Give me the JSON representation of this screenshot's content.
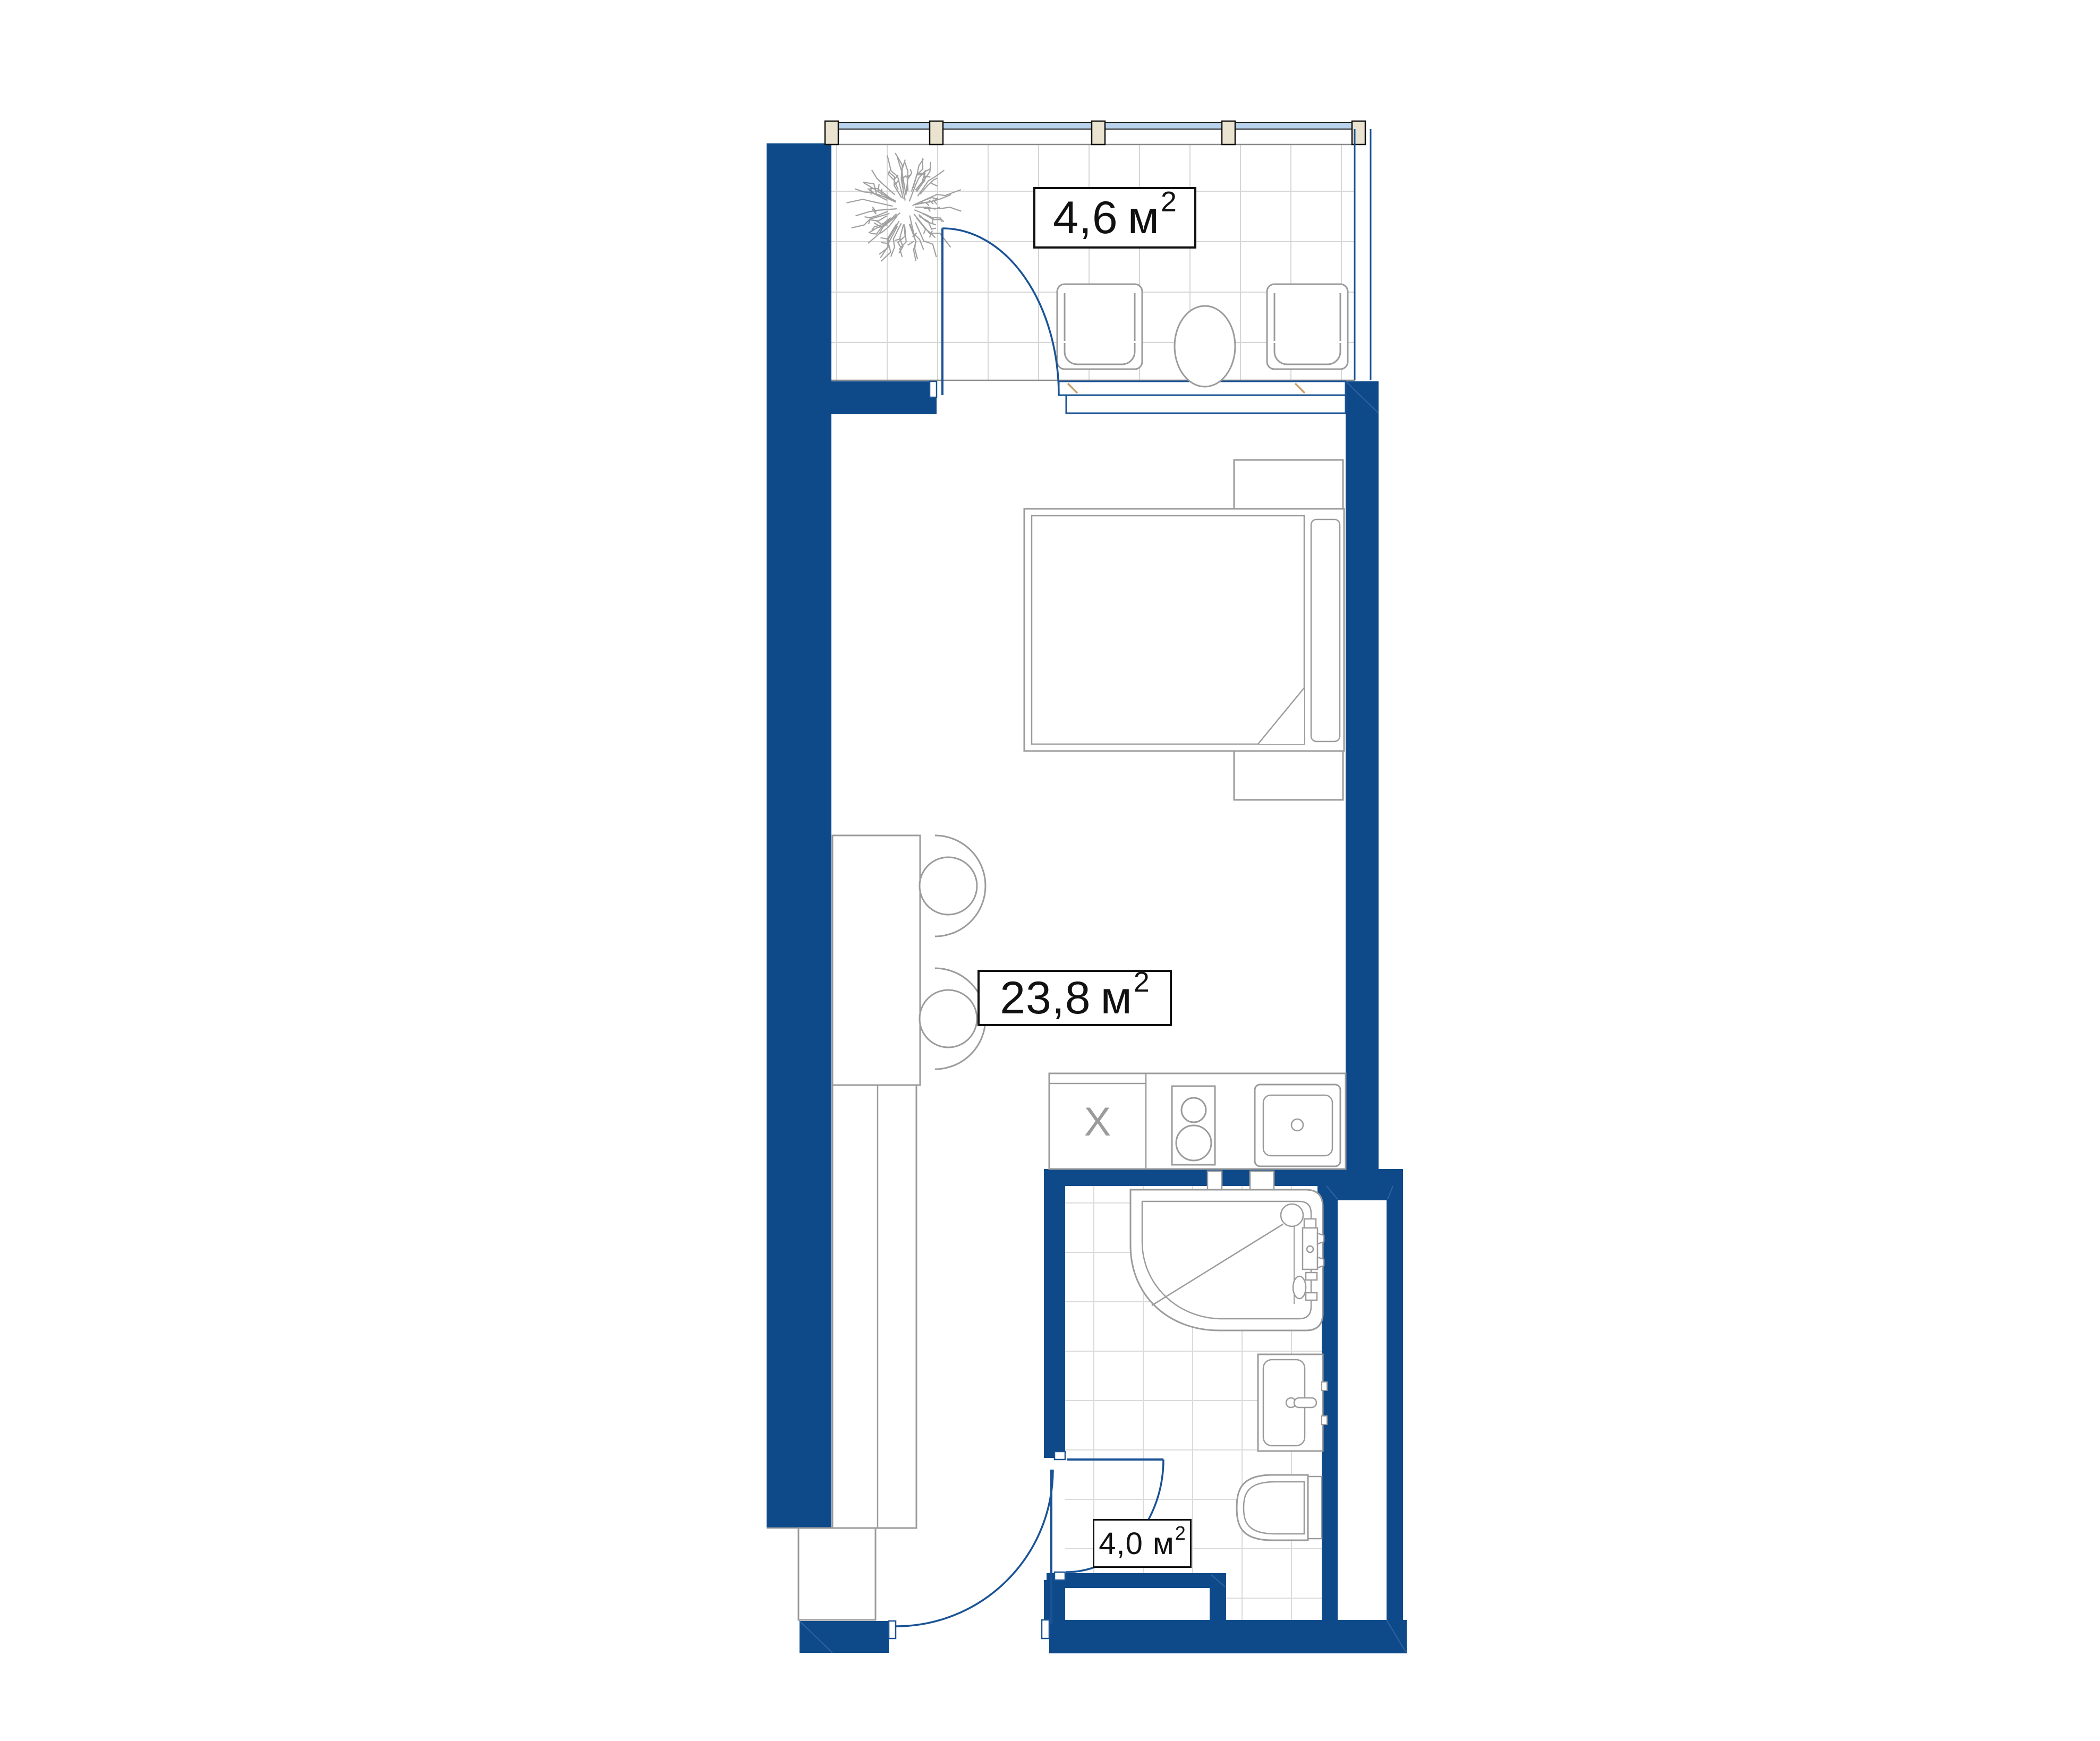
{
  "plan": {
    "labels": {
      "balcony": {
        "value": "4,6",
        "unit": "м",
        "sup": "2"
      },
      "living": {
        "value": "23,8",
        "unit": "м",
        "sup": "2"
      },
      "bathroom": {
        "value": "4,0",
        "unit": "м",
        "sup": "2"
      }
    },
    "kitchen": {
      "unit_marker": "X"
    },
    "colors": {
      "wall": "#0e4a8a",
      "door_line": "#1a5295",
      "fixture_line": "#9b9b9b",
      "glazing": "#b9d3ec",
      "mullion": "#eae3d0",
      "tile_line": "#d6d6d6",
      "sill_tick": "#c9a06b"
    }
  }
}
